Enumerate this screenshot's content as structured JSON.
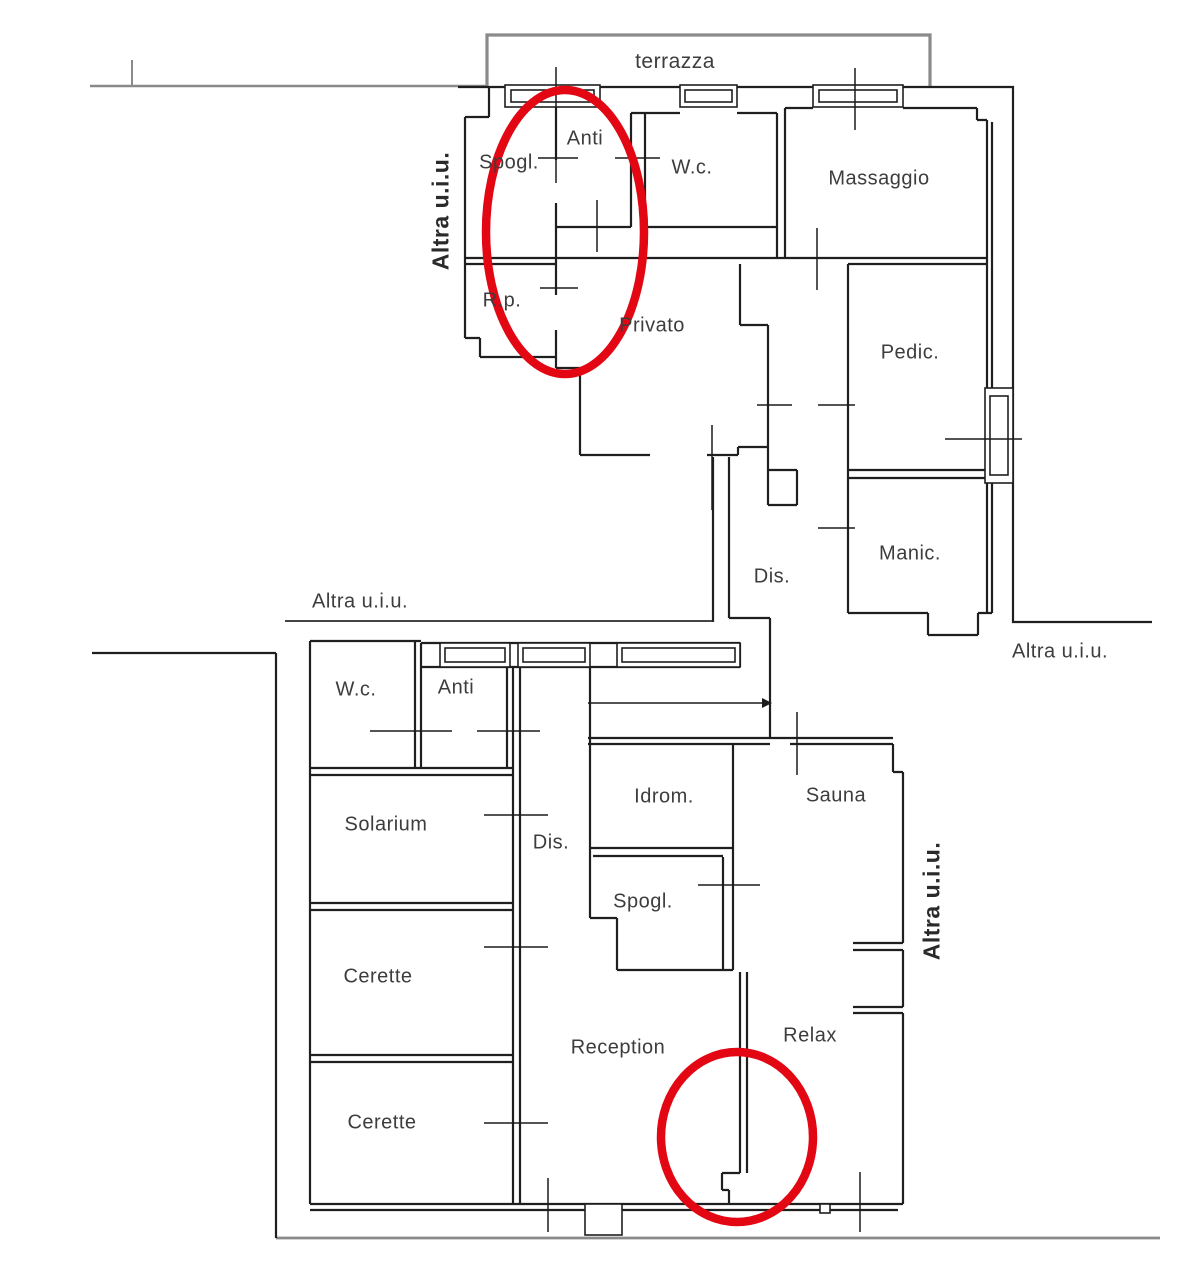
{
  "colors": {
    "wall": "#1f1f1f",
    "terrace_outline": "#8a8a8a",
    "boundary_gray": "#7a7a7a",
    "highlight_red": "#e30613",
    "label_text": "#3d3d3d"
  },
  "plan": {
    "terrace_label": "terrazza",
    "adjacent_unit_label": "Altra u.i.u.",
    "upper_unit": {
      "rooms": [
        {
          "label": "Spogl."
        },
        {
          "label": "Anti"
        },
        {
          "label": "W.c."
        },
        {
          "label": "Massaggio"
        },
        {
          "label": "R.p."
        },
        {
          "label": "Privato"
        },
        {
          "label": "Pedic."
        },
        {
          "label": "Dis."
        },
        {
          "label": "Manic."
        }
      ]
    },
    "lower_unit": {
      "rooms": [
        {
          "label": "W.c."
        },
        {
          "label": "Anti"
        },
        {
          "label": "Solarium"
        },
        {
          "label": "Dis."
        },
        {
          "label": "Idrom."
        },
        {
          "label": "Sauna"
        },
        {
          "label": "Spogl."
        },
        {
          "label": "Cerette"
        },
        {
          "label": "Reception"
        },
        {
          "label": "Relax"
        },
        {
          "label": "Cerette"
        }
      ]
    },
    "annotations": {
      "highlight_count": 2
    }
  }
}
